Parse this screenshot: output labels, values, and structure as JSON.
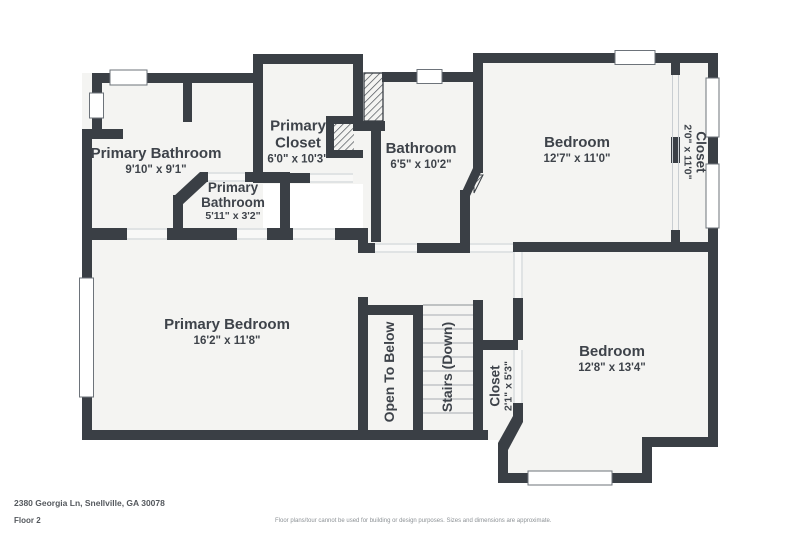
{
  "plan": {
    "title": "Floor plan, second floor",
    "rooms": [
      {
        "name": "Primary Bathroom",
        "dims": "9'10\" x 9'1\""
      },
      {
        "name": "Primary Closet",
        "dims": "6'0\" x 10'3\""
      },
      {
        "name": "Primary Bathroom",
        "dims": "5'11\" x 3'2\""
      },
      {
        "name": "Bathroom",
        "dims": "6'5\" x 10'2\""
      },
      {
        "name": "Bedroom",
        "dims": "12'7\" x 11'0\""
      },
      {
        "name": "Closet",
        "dims": "2'0\" x 11'0\""
      },
      {
        "name": "Primary Bedroom",
        "dims": "16'2\" x 11'8\""
      },
      {
        "name": "Open To Below",
        "dims": ""
      },
      {
        "name": "Stairs (Down)",
        "dims": ""
      },
      {
        "name": "Closet",
        "dims": "2'1\" x 5'3\""
      },
      {
        "name": "Bedroom",
        "dims": "12'8\" x 13'4\""
      }
    ]
  },
  "footer": {
    "address": "2380 Georgia Ln, Snellville, GA 30078",
    "floor_label": "Floor 2",
    "disclaimer": "Floor plans/tour cannot be used for building or design purposes. Sizes and dimensions are approximate."
  },
  "colors": {
    "background": "#ffffff",
    "wall": "#3a3f45",
    "floor": "#f4f4f2",
    "window_outline": "#6d737a",
    "door_line": "#c9ced2",
    "stair_tread": "#b6bbbf",
    "label_text": "#3e434a",
    "footer_text": "#54585d",
    "disclaimer_text": "#8d9296"
  }
}
